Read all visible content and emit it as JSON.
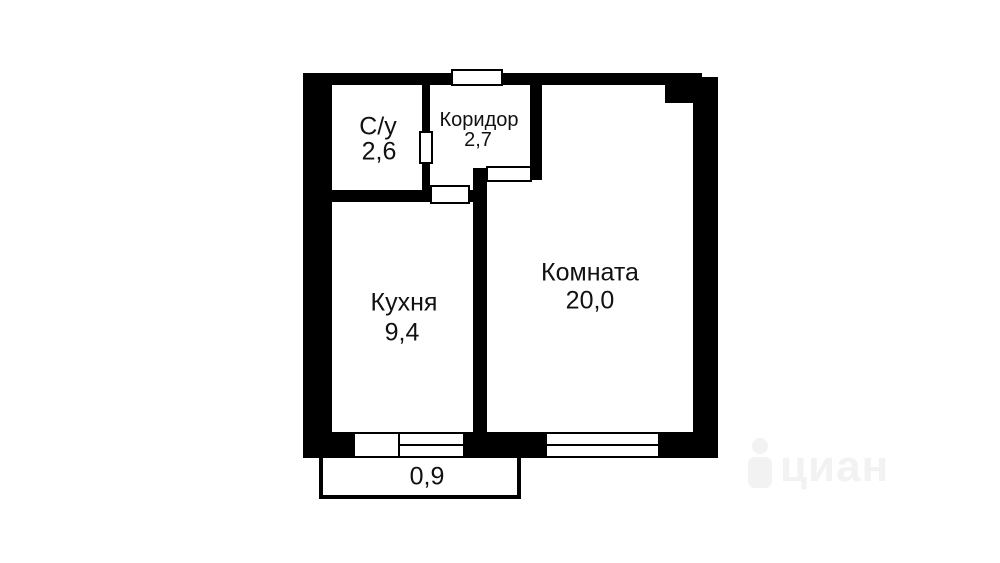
{
  "plan": {
    "type": "apartment-floor-plan",
    "rooms": [
      {
        "key": "bathroom",
        "label": "С/у",
        "area": "2,6"
      },
      {
        "key": "corridor",
        "label": "Коридор",
        "area": "2,7"
      },
      {
        "key": "kitchen",
        "label": "Кухня",
        "area": "9,4"
      },
      {
        "key": "room",
        "label": "Комната",
        "area": "20,0"
      },
      {
        "key": "balcony",
        "label": "",
        "area": "0,9"
      }
    ],
    "watermark": {
      "text": "циан"
    },
    "colors": {
      "wall": "#000000",
      "background": "#ffffff",
      "label_text": "#111111",
      "watermark": "#f2f2f2"
    }
  }
}
